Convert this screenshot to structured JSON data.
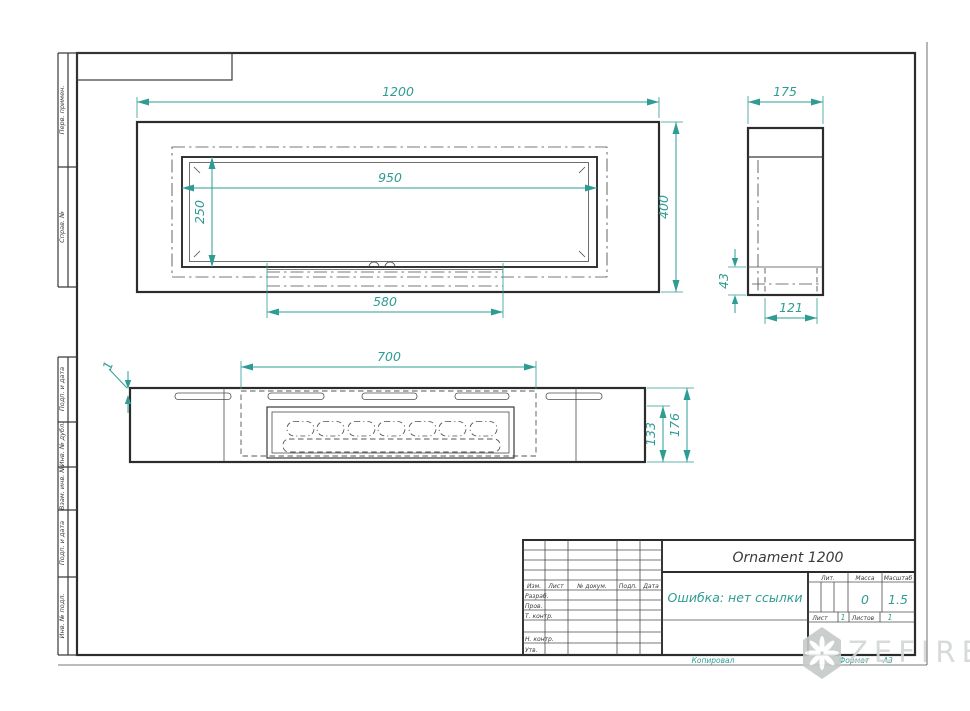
{
  "colors": {
    "line": "#2c2c2c",
    "dimension": "#2f9c94",
    "watermark": "#ccd1d0"
  },
  "margin": {
    "top_labels": [
      "Перв. примен.",
      "Справ. №"
    ],
    "bottom_labels": [
      "Подп. и дата",
      "Инв. № дубл.",
      "Взам. инв. №",
      "Подп. и дата",
      "Инв. № подл."
    ]
  },
  "views": {
    "top": {
      "width": "1200",
      "height": "400",
      "opening_width": "950",
      "opening_height": "250",
      "base_width": "580"
    },
    "side": {
      "width": "175",
      "base_height": "43",
      "base_depth": "121"
    },
    "front": {
      "burner_width": "700",
      "lip_thickness": "1",
      "insert_height": "133",
      "total_height": "176"
    }
  },
  "title_block": {
    "title": "Ornament 1200",
    "name_cell": "Ошибка: нет ссылки",
    "header_cols": [
      "Изм.",
      "Лист",
      "№ докум.",
      "Подп.",
      "Дата"
    ],
    "row_labels": [
      "Разраб.",
      "Пров.",
      "Т. контр.",
      "Н. контр.",
      "Утв."
    ],
    "lit_label": "Лит.",
    "mass_label": "Масса",
    "scale_label": "Масштаб",
    "mass_value": "0",
    "scale_value": "1.5",
    "sheet_label": "Лист",
    "sheet_value": "1",
    "sheets_label": "Листов",
    "sheets_value": "1"
  },
  "footer": {
    "copied": "Копировал",
    "format_label": "Формат",
    "format_value": "А3"
  },
  "watermark": {
    "text": "ZEFIRE"
  }
}
